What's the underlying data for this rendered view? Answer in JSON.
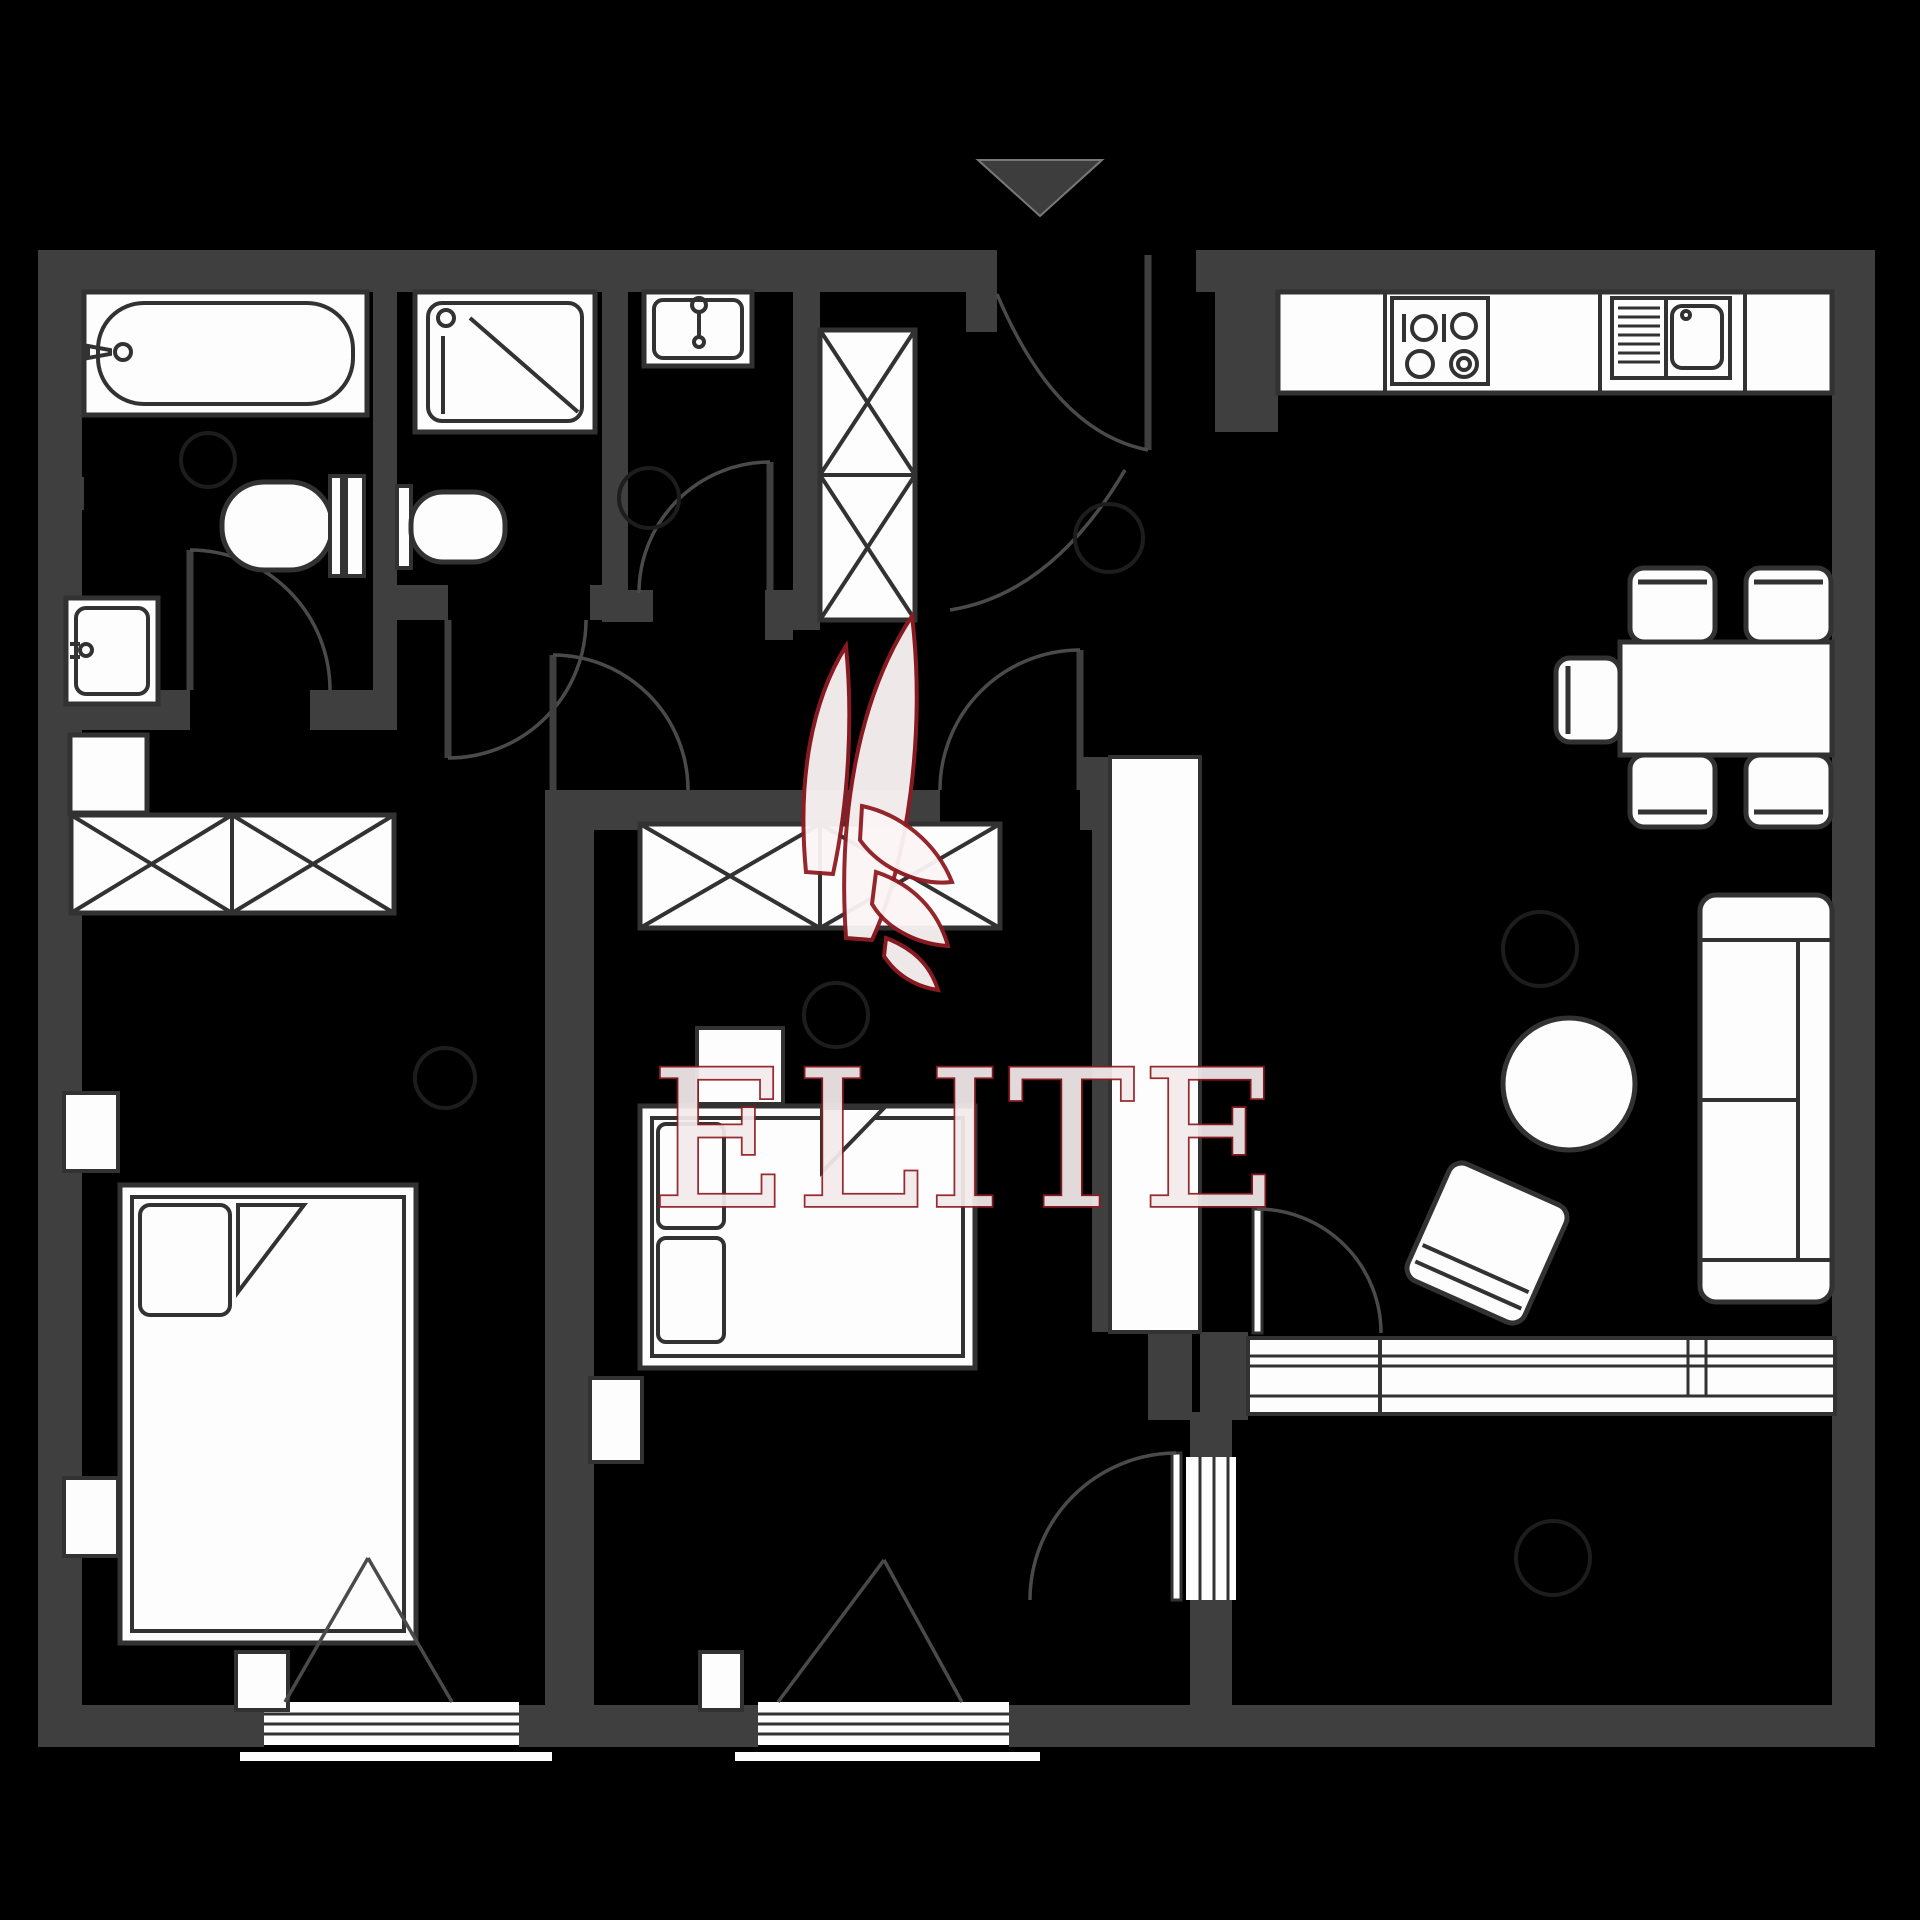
{
  "watermark": {
    "text": "ELITE",
    "logo": "sailboat-sails-logo",
    "text_color": "#f4ebeb",
    "accent": "#8f1c22"
  },
  "palette": {
    "background": "#000000",
    "wall": "#3f3f3f",
    "furniture_fill": "#fdfdfd",
    "line": "#323232",
    "arc": "#4a4a4a",
    "light_circle": "#1d1d1d",
    "accent_color": "#8f1c22"
  },
  "plan": {
    "type": "apartment-floor-plan",
    "entrance_marker": "down-arrow",
    "rooms": [
      {
        "name": "bathroom",
        "furniture": [
          "bathtub",
          "wall-sink",
          "toilet",
          "cabinet"
        ]
      },
      {
        "name": "shower-room",
        "furniture": [
          "shower-tray",
          "toilet"
        ]
      },
      {
        "name": "wc",
        "furniture": [
          "washbasin",
          "ceiling-light"
        ]
      },
      {
        "name": "hallway",
        "furniture": [
          "tall-wardrobe",
          "ceiling-light"
        ]
      },
      {
        "name": "kitchen-living-room",
        "furniture": [
          "kitchen-counter",
          "stove-4-burners",
          "kitchen-sink",
          "dining-table",
          "chair",
          "chair",
          "chair",
          "chair",
          "chair",
          "sofa-2-seat",
          "round-table",
          "armchair",
          "ceiling-light",
          "window-wall"
        ]
      },
      {
        "name": "bedroom-1",
        "furniture": [
          "wardrobe-x2",
          "double-bed",
          "pillow",
          "nightstand",
          "nightstand",
          "window",
          "ceiling-light"
        ]
      },
      {
        "name": "bedroom-2",
        "furniture": [
          "wardrobe-x2",
          "double-bed",
          "pillow",
          "pillow",
          "nightstand",
          "nightstand",
          "window",
          "ceiling-light"
        ]
      },
      {
        "name": "balcony",
        "furniture": [
          "ceiling-light"
        ]
      }
    ],
    "doors": [
      "entrance-door",
      "vestibule-door",
      "bathroom-door",
      "shower-room-door",
      "wc-door",
      "hall-door",
      "bedroom-2-door",
      "living-room-balcony-door",
      "bedroom-2-balcony-door"
    ]
  }
}
